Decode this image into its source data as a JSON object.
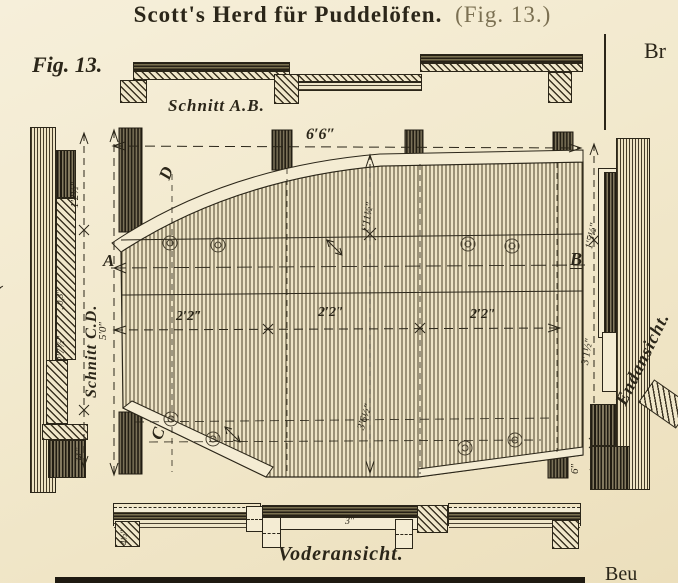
{
  "palette": {
    "paper": "#f2e9cd",
    "ink": "#2b2619"
  },
  "title": {
    "main": "Scott's Herd für Puddelöfen.",
    "fig_ref": "(Fig. 13.)"
  },
  "figure_label": "Fig. 13.",
  "margin": {
    "right_fragment": "Br",
    "bottom_fragment": "Beu",
    "left_fragment": "("
  },
  "top_section": {
    "caption": "Schnitt A.B."
  },
  "left_section": {
    "caption": "Schnitt C.D.",
    "dim_top": "1′2½″",
    "dim_small": "„0,3″",
    "dim_mid": "2′7½″",
    "dim_bottom": "11″",
    "dim_overall": "5′0″"
  },
  "plan": {
    "dim_width": "6′6″",
    "point_a": "A",
    "point_b": "B",
    "point_c": "C",
    "point_d": "D",
    "dim_seg1": "2′2″",
    "dim_seg2": "2′2″",
    "dim_seg3": "2′2″",
    "dim_upper": "1′11½″",
    "dim_lower": "3′6½″"
  },
  "end_view": {
    "caption": "Endansicht.",
    "dim_top": "1′5½″",
    "dim_mid": "3′1½″",
    "dim_bottom": "6″"
  },
  "front_view": {
    "caption": "Voderansicht.",
    "dim_left": "4½″",
    "dim_mid": "3″"
  }
}
